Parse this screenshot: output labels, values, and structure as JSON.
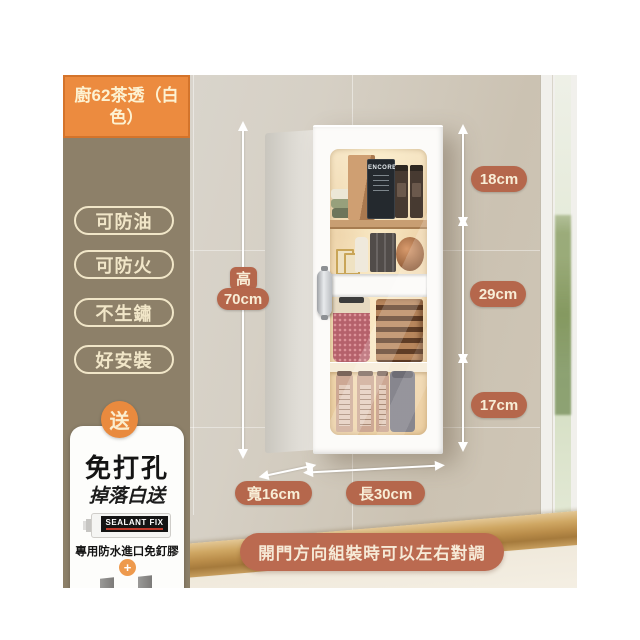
{
  "product_badge": {
    "title": "廚62茶透（白色）"
  },
  "features": [
    {
      "label": "可防油"
    },
    {
      "label": "可防火"
    },
    {
      "label": "不生鏽"
    },
    {
      "label": "好安裝"
    }
  ],
  "gift": {
    "badge": "送",
    "headline": "免打孔",
    "subheadline": "掉落白送",
    "glue_brand": "SEALANT FIX",
    "glue_caption": "專用防水進口免釘膠",
    "plus": "+",
    "hooks_caption": "304不鏽鋼加厚掛件"
  },
  "dimensions": {
    "height_label": "高",
    "height_value": "70cm",
    "top_section": "18cm",
    "middle_section": "29cm",
    "bottom_section": "17cm",
    "depth": "寬16cm",
    "width": "長30cm"
  },
  "banner": {
    "text": "開門方向組裝時可以左右對調"
  },
  "cabinet": {
    "chalkboard_text": "ENCORE"
  },
  "colors": {
    "accent_orange": "#ec8b3f",
    "terracotta": "#b5674c",
    "banner_terracotta": "#bb6a50",
    "panel_tan": "#8d8069",
    "cream_text": "#f8edd6"
  }
}
